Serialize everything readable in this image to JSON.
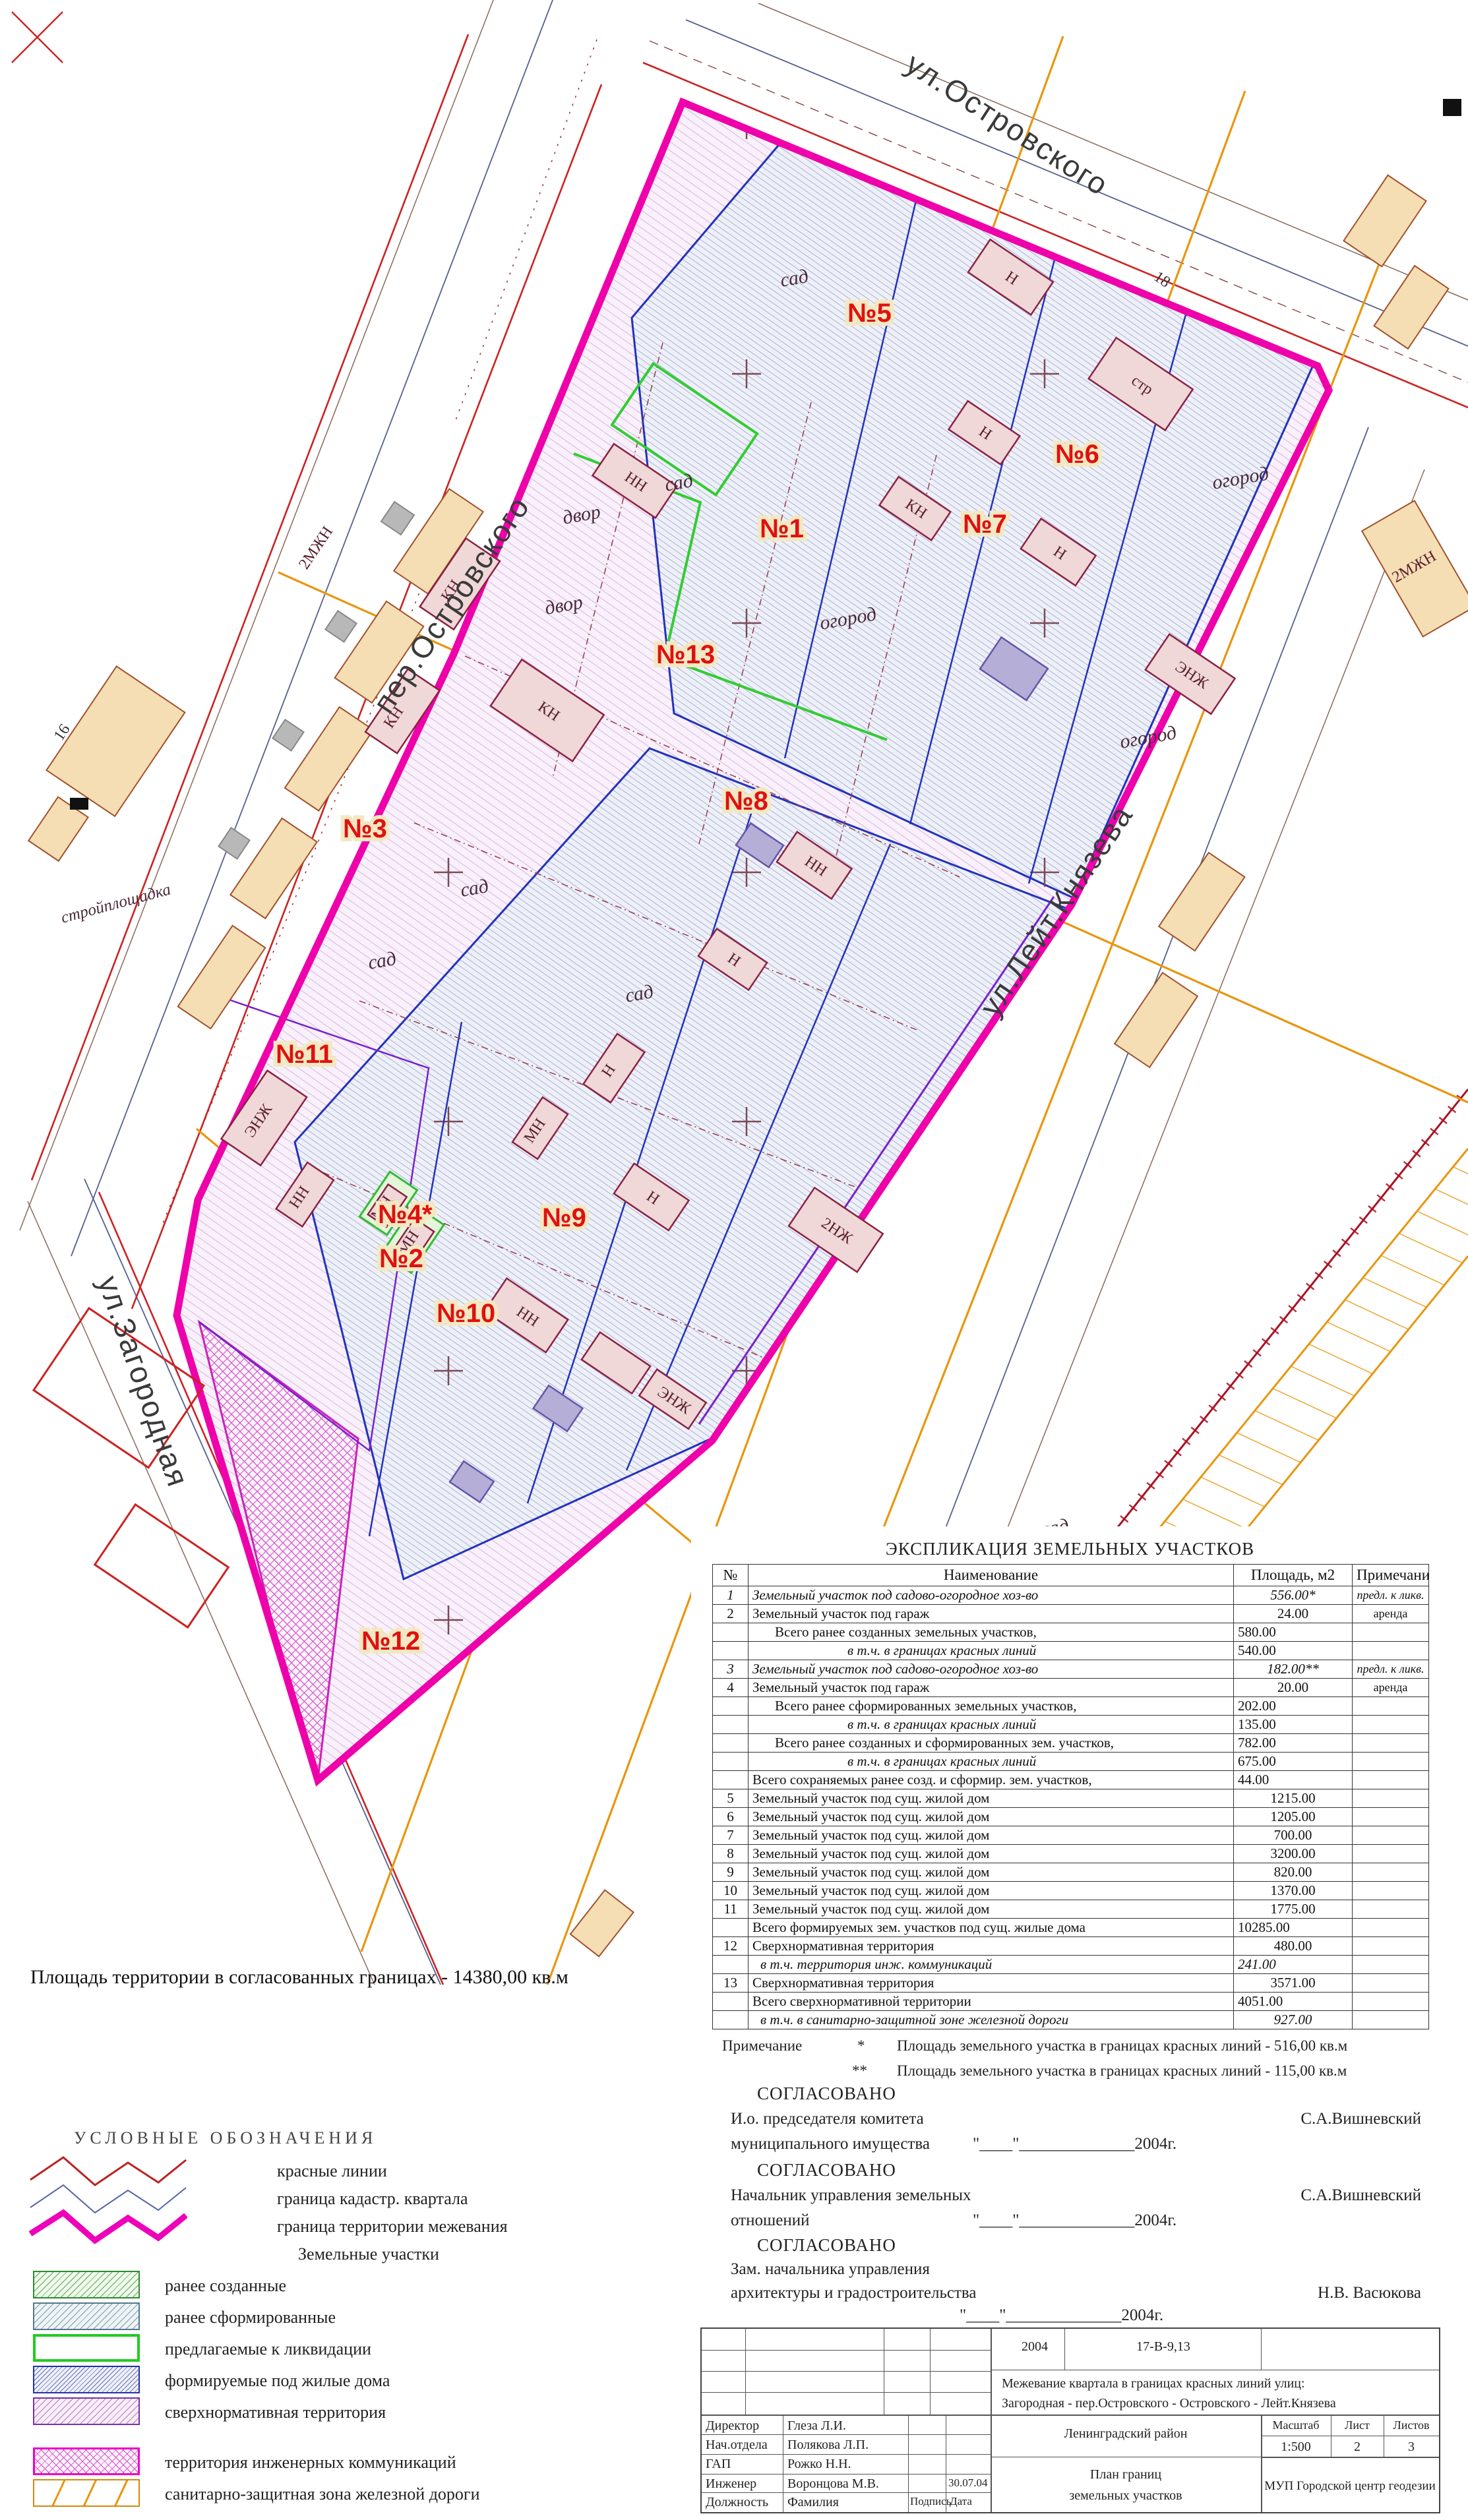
{
  "map": {
    "streets": [
      "ул.Островского",
      "пер.Островского",
      "ул.Лейт.Князева",
      "ул.Загородная"
    ],
    "parcels": [
      "№1",
      "№2",
      "№3",
      "№4*",
      "№5",
      "№6",
      "№7",
      "№8",
      "№9",
      "№10",
      "№11",
      "№12",
      "№13"
    ],
    "terrain": {
      "sad": "сад",
      "ogorod": "огород",
      "dvor": "двор",
      "stroy": "стройплощадка",
      "str": "стр"
    },
    "building_marks": {
      "n": "Н",
      "kn": "КН",
      "mn": "МН",
      "nn": "НН",
      "zh2": "2НЖ",
      "ezh": "ЭНЖ",
      "mzh": "2МЖН"
    },
    "house_numbers": {
      "n16": "16",
      "n18": "18",
      "n30": "30"
    },
    "area_note": "Площадь территории в согласованных границах - 14380,00 кв.м"
  },
  "table": {
    "title": "ЭКСПЛИКАЦИЯ ЗЕМЕЛЬНЫХ  УЧАСТКОВ",
    "columns": [
      "№",
      "Наименование",
      "Площадь, м2",
      "Примечание"
    ],
    "rows": [
      {
        "num": "1",
        "name": "Земельный участок под садово-огородное хоз-во",
        "area": "556.00*",
        "note": "предл. к ликв."
      },
      {
        "num": "2",
        "name": "Земельный участок под гараж",
        "area": "24.00",
        "note": "аренда"
      },
      {
        "num": "",
        "name": "Всего  ранее созданных земельных участков,",
        "area": "580.00",
        "note": ""
      },
      {
        "num": "",
        "name": "в т.ч. в границах красных линий",
        "area": "540.00",
        "note": ""
      },
      {
        "num": "3",
        "name": "Земельный участок под садово-огородное хоз-во",
        "area": "182.00**",
        "note": "предл. к ликв."
      },
      {
        "num": "4",
        "name": "Земельный участок под гараж",
        "area": "20.00",
        "note": "аренда"
      },
      {
        "num": "",
        "name": "Всего  ранее сформированных земельных участков,",
        "area": "202.00",
        "note": ""
      },
      {
        "num": "",
        "name": "в т.ч. в границах красных линий",
        "area": "135.00",
        "note": ""
      },
      {
        "num": "",
        "name": "Всего  ранее созданных и сформированных зем. участков,",
        "area": "782.00",
        "note": ""
      },
      {
        "num": "",
        "name": "в т.ч. в границах красных линий",
        "area": "675.00",
        "note": ""
      },
      {
        "num": "",
        "name": "Всего сохраняемых ранее созд. и сформир. зем. участков,",
        "area": "44.00",
        "note": ""
      },
      {
        "num": "5",
        "name": "Земельный участок под сущ. жилой дом",
        "area": "1215.00",
        "note": ""
      },
      {
        "num": "6",
        "name": "Земельный участок под сущ. жилой дом",
        "area": "1205.00",
        "note": ""
      },
      {
        "num": "7",
        "name": "Земельный участок под сущ. жилой дом",
        "area": "700.00",
        "note": ""
      },
      {
        "num": "8",
        "name": "Земельный участок под сущ. жилой дом",
        "area": "3200.00",
        "note": ""
      },
      {
        "num": "9",
        "name": "Земельный участок под сущ. жилой дом",
        "area": "820.00",
        "note": ""
      },
      {
        "num": "10",
        "name": "Земельный участок под сущ. жилой дом",
        "area": "1370.00",
        "note": ""
      },
      {
        "num": "11",
        "name": "Земельный участок под сущ. жилой дом",
        "area": "1775.00",
        "note": ""
      },
      {
        "num": "",
        "name": "Всего  формируемых зем. участков под сущ. жилые дома",
        "area": "10285.00",
        "note": ""
      },
      {
        "num": "12",
        "name": "Сверхнормативная территория",
        "area": "480.00",
        "note": ""
      },
      {
        "num": "",
        "name": "в т.ч. территория инж. коммуникаций",
        "area": "241.00",
        "note": ""
      },
      {
        "num": "13",
        "name": "Сверхнормативная территория",
        "area": "3571.00",
        "note": ""
      },
      {
        "num": "",
        "name": "Всего сверхнормативной территории",
        "area": "4051.00",
        "note": ""
      },
      {
        "num": "",
        "name": "в т.ч. в санитарно-защитной зоне железной дороги",
        "area": "927.00",
        "note": ""
      }
    ]
  },
  "notes": {
    "label": "Примечание",
    "mark1": "*",
    "text1": "Площадь земельного участка в границах красных линий - 516,00 кв.м",
    "mark2": "**",
    "text2": "Площадь земельного участка в границах красных линий - 115,00 кв.м"
  },
  "approvals": {
    "heading": "СОГЛАСОВАНО",
    "items": [
      {
        "role1": "И.о. председателя комитета",
        "role2": "муниципального имущества",
        "date": "\"____\"______________2004г.",
        "name": "С.А.Вишневский"
      },
      {
        "role1": "Начальник управления земельных",
        "role2": "отношений",
        "date": "\"____\"______________2004г.",
        "name": "С.А.Вишневский"
      },
      {
        "role1": "Зам. начальника управления",
        "role2": "архитектуры и градостроительства",
        "date": "\"____\"______________2004г.",
        "name": "Н.В. Васюкова"
      }
    ]
  },
  "title_block": {
    "year": "2004",
    "code": "17-В-9,13",
    "subject1": "Межевание квартала в границах красных линий улиц:",
    "subject2": "Загородная - пер.Островского - Островского - Лейт.Князева",
    "staff": [
      {
        "role": "Директор",
        "name": "Глеза Л.И.",
        "sign": "",
        "date": ""
      },
      {
        "role": "Нач.отдела",
        "name": "Полякова Л.П.",
        "sign": "",
        "date": ""
      },
      {
        "role": "ГАП",
        "name": "Рожко Н.Н.",
        "sign": "",
        "date": ""
      },
      {
        "role": "Инженер",
        "name": "Воронцова М.В.",
        "sign": "",
        "date": "30.07.04"
      },
      {
        "role": "Должность",
        "name": "Фамилия",
        "sign": "Подпись",
        "date": "Дата"
      }
    ],
    "district": "Ленинградский район",
    "plan1": "План границ",
    "plan2": "земельных участков",
    "scale_label": "Масштаб",
    "scale": "1:500",
    "sheet_label": "Лист",
    "sheet": "2",
    "sheets_label": "Листов",
    "sheets": "3",
    "org": "МУП Городской центр геодезии"
  },
  "legend": {
    "title": "УСЛОВНЫЕ  ОБОЗНАЧЕНИЯ",
    "line_items": [
      {
        "label": "красные линии",
        "color": "#bb2222"
      },
      {
        "label": "граница кадастр. квартала",
        "color": "#5566aa"
      },
      {
        "label": "граница территории межевания",
        "color": "#ee00bb"
      }
    ],
    "subtitle": "Земельные участки",
    "swatch_items": [
      {
        "label": "ранее созданные"
      },
      {
        "label": "ранее сформированные"
      },
      {
        "label": "предлагаемые к ликвидации"
      },
      {
        "label": "формируемые под жилые дома"
      },
      {
        "label": "сверхнормативная территория"
      }
    ],
    "extra_items": [
      {
        "label": "территория инженерных коммуникаций"
      },
      {
        "label": "санитарно-защитная зона железной дороги"
      }
    ]
  },
  "colors": {
    "boundary": "#ee00aa",
    "red_line": "#cc2222",
    "cadastral_line": "#5566aa",
    "liquidation_green": "#33cc33",
    "formed_blue": "#2233bb",
    "comm_orange": "#e8960f",
    "parcel_label_red": "#e01010"
  }
}
